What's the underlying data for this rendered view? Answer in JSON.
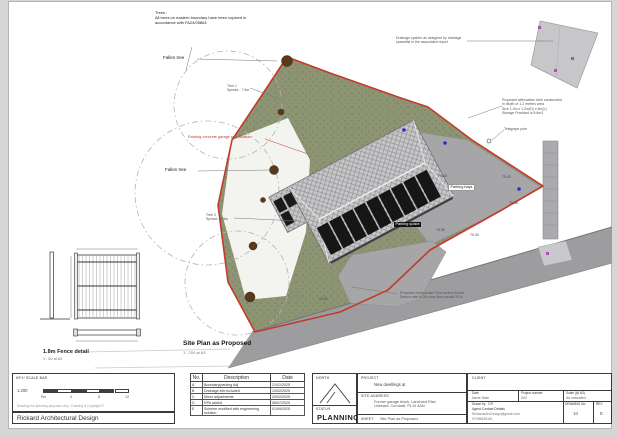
{
  "plan": {
    "labels": {
      "trees_note": "Trees :\nAll trees on eastern boundary have been copiced in\naccordance with FA24/05864",
      "drainage_note": "Drainage system as designed by drainage specialist in the associated report",
      "fallen_tree_upper": "Fallen tree",
      "fallen_tree_lower": "Fallen tree",
      "tree1": "Tree 1\nSpread - 7.5m",
      "tree2": "Tree 2\nSpread - 9.5m",
      "existing_pad": "Existing concrete garage pad location",
      "attenuation_note": "Proposed attenuation tank constructed\nin depth of 1.2 metres area\nSize 1.2m x 1.2m(D) x 6m(L)\nStorage Provided is 8.6m3",
      "telegraph_pole": "Telegraph pole",
      "hydrobrake_note": "Proposed hydrobrake Flow control device\nDevice rate of 2l/s max flow annual 2l/1s",
      "parking_bays": "Parking bays",
      "parking_space": "Parking space",
      "title": "Site Plan as Proposed",
      "scale": "1 : 200 at A3"
    },
    "spot_levels": [
      "75.43",
      "75.40",
      "75.38",
      "75.35",
      "75.33",
      "75.21"
    ]
  },
  "fence_detail": {
    "title": "1.8m Fence detail",
    "scale": "1 : 50 at A3"
  },
  "titleblock": {
    "scalebar": {
      "key_label": "KEY/ SCALE BAR",
      "ratio": "1:200",
      "tick_labels": [
        "0m",
        "4",
        "8",
        "12"
      ],
      "disclaimer": "Drawings for planning purposes only - Drawing is Copyright ©",
      "firm": "Rickard Architectural Design"
    },
    "revisions": {
      "headers": [
        "No.",
        "Description",
        "Date"
      ],
      "rows": [
        [
          "A",
          "Boundary/parking Adj",
          "21/01/2025"
        ],
        [
          "B",
          "Drainage info included",
          "13/02/2025"
        ],
        [
          "C",
          "Minor adjustments",
          "20/02/2025"
        ],
        [
          "D",
          "RPA added",
          "08/07/2025"
        ],
        [
          "E",
          "Scheme modified with engineering solution",
          "01/09/2025"
        ]
      ]
    },
    "north": {
      "north_label": "NORTH",
      "status_label": "STATUS",
      "status_value": "PLANNING"
    },
    "project": {
      "project_label": "PROJECT",
      "project_value": "New dwellings at",
      "site_address_label": "SITE ADDRESS",
      "site_address_value": "Former garage block, Lanchard Rise,\nLiskeard, Cornwall, PL14 4AN",
      "sheet_label": "SHEET",
      "sheet_value": "Site Plan as Proposed"
    },
    "client": {
      "client_label": "CLIENT",
      "date_label": "Date",
      "date_value": "Issue Date",
      "project_number_label": "Project number",
      "project_number_value": "002",
      "scale_label": "Scale (@ A3)",
      "scale_value": "As indicated",
      "drawn_by_label": "Drawn by",
      "drawn_by_value": "DR",
      "agent_label": "Agent Contact Details",
      "agent_email": "RickardsArcDesign@gmail.com",
      "agent_phone": "07498498151",
      "drawing_no_label": "DRAWING No.",
      "drawing_no_value": "10",
      "rev_label": "REV",
      "rev_value": "E"
    }
  },
  "colors": {
    "boundary_red": "#c23b2a",
    "site_green": "#8d9473",
    "road_gray": "#9d9da0",
    "roof_gray": "#c6c6c8",
    "panel_black": "#161616",
    "tree_brown": "#5a3a1c",
    "marker_blue": "#2b2bd4",
    "marker_magenta": "#b24fb2"
  }
}
